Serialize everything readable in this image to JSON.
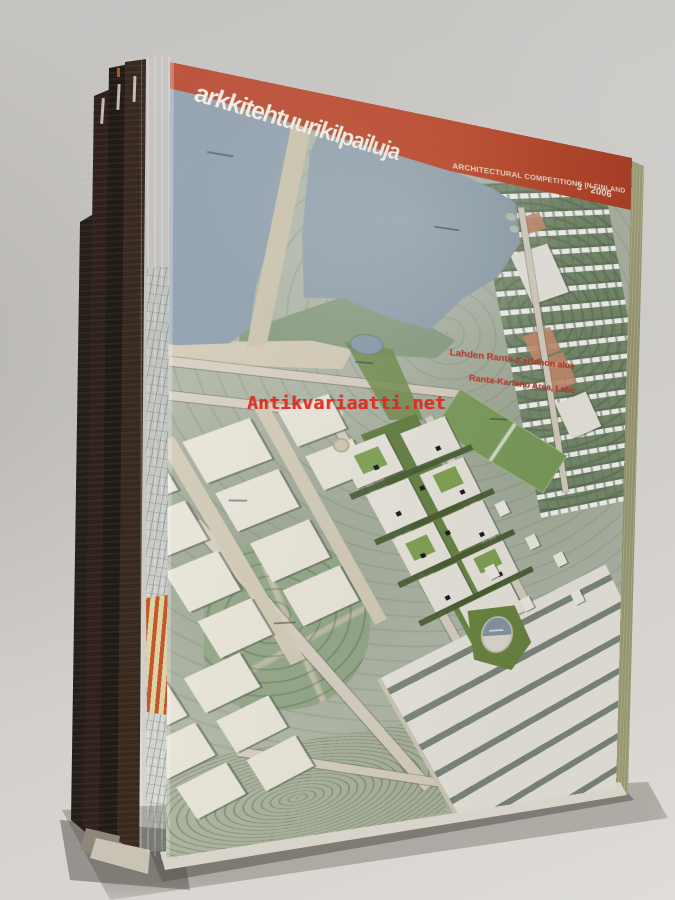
{
  "watermark": {
    "text": "Antikvariaatti.net",
    "color": "#e0281c"
  },
  "cover": {
    "masthead": "arkkitehtuurikilpailuja",
    "subtitle": "ARCHITECTURAL COMPETITIONS IN FINLAND",
    "issue": "3 · 2006",
    "map_label_fi": "Lahden Ranta-Kartanon alue",
    "map_label_en": "Ranta-Kartano Area, Lahti",
    "colors": {
      "banner_red": "#b8452a",
      "map_label_red": "#c0392a",
      "water_blue": "#8c9cab",
      "page_edge_olive": "#93926c",
      "development_green": "#65803f"
    }
  }
}
